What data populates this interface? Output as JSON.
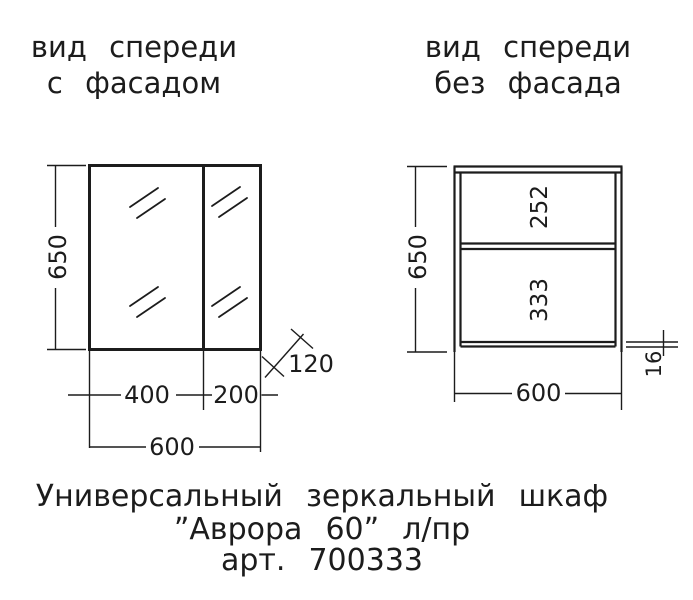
{
  "titles": {
    "left": {
      "line1": "вид спереди",
      "line2": "с фасадом"
    },
    "right": {
      "line1": "вид спереди",
      "line2": "без фасада"
    }
  },
  "left_view": {
    "height": "650",
    "left_door_width": "400",
    "right_door_width": "200",
    "total_width": "600",
    "depth": "120"
  },
  "right_view": {
    "height": "650",
    "upper_compartment_height": "252",
    "lower_compartment_height": "333",
    "width": "600",
    "panel_thickness": "16"
  },
  "caption": {
    "line1": "Универсальный зеркальный шкаф",
    "line2": "”Аврора 60” л/пр",
    "line3": "арт. 700333"
  },
  "colors": {
    "ink": "#1c1c1c",
    "background": "#ffffff"
  }
}
